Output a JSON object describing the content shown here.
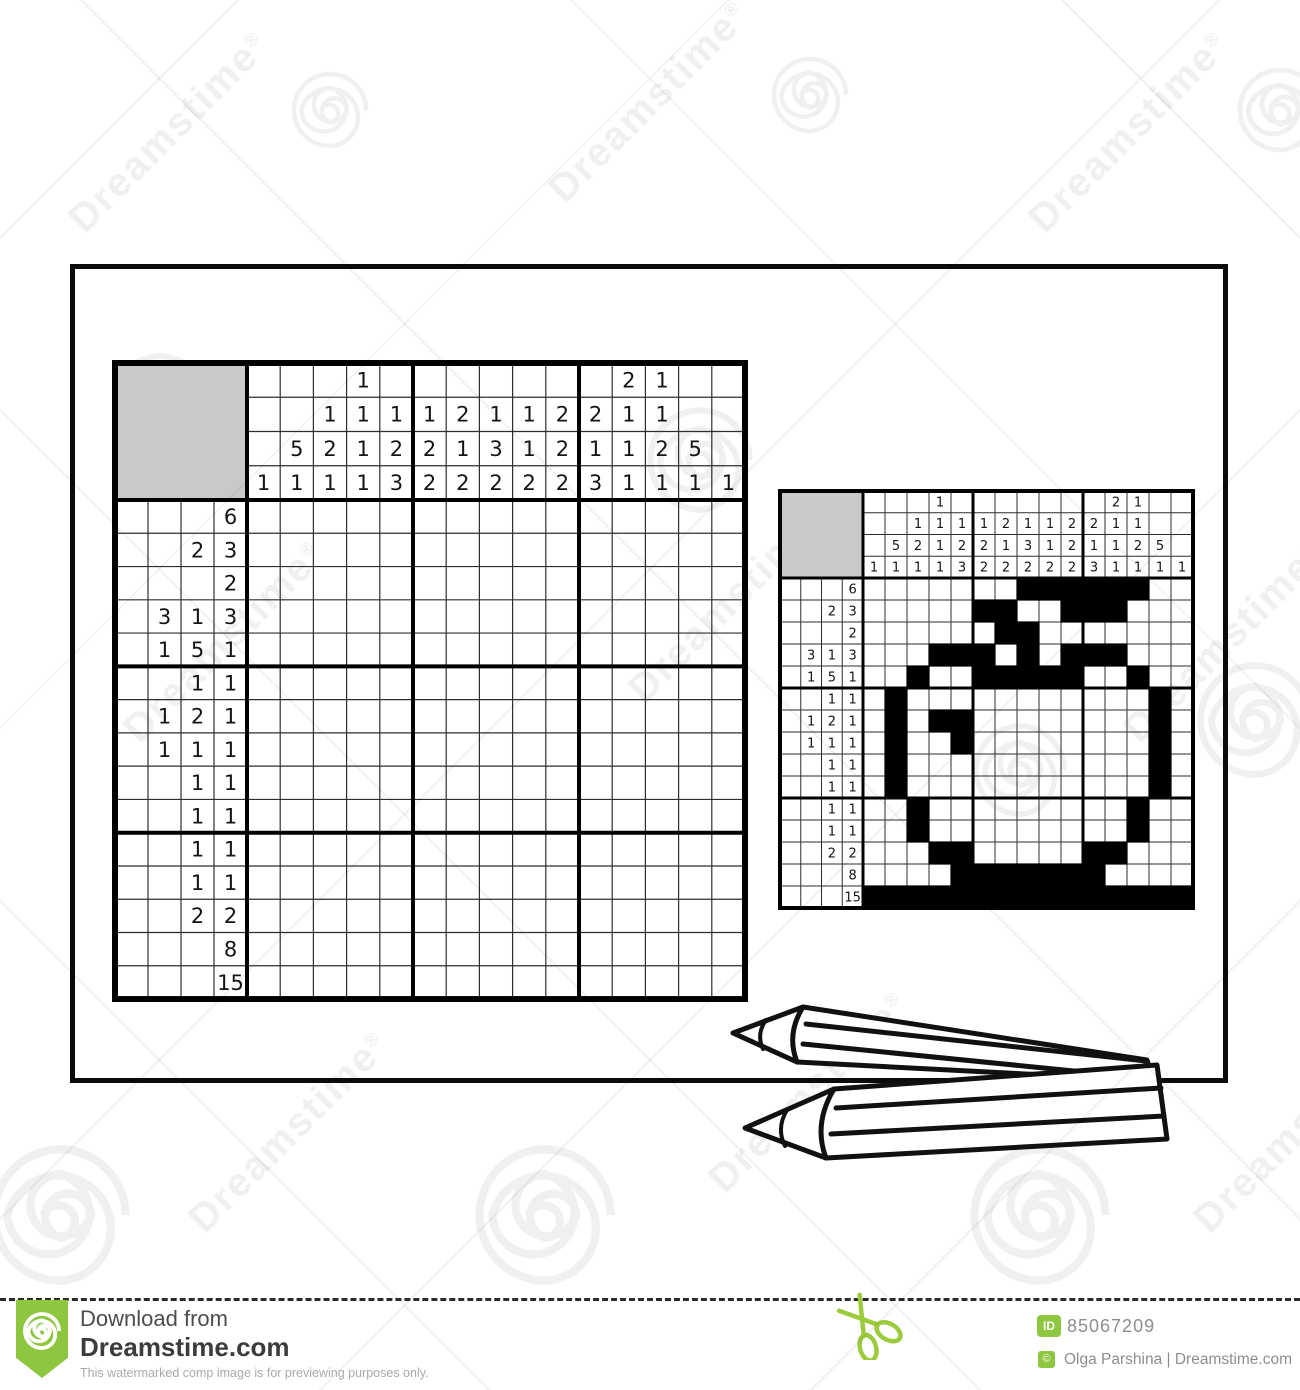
{
  "watermark": {
    "brand": "Dreamstime",
    "registered": "®"
  },
  "nonogram": {
    "size": 15,
    "clue_depth": 4,
    "row_clues": [
      [
        6
      ],
      [
        2,
        3
      ],
      [
        2
      ],
      [
        3,
        1,
        3
      ],
      [
        1,
        5,
        1
      ],
      [
        1,
        1
      ],
      [
        1,
        2,
        1
      ],
      [
        1,
        1,
        1
      ],
      [
        1,
        1
      ],
      [
        1,
        1
      ],
      [
        1,
        1
      ],
      [
        1,
        1
      ],
      [
        2,
        2
      ],
      [
        8
      ],
      [
        15
      ]
    ],
    "col_clues": [
      [
        1
      ],
      [
        5,
        1
      ],
      [
        1,
        2,
        1
      ],
      [
        1,
        1,
        1,
        1
      ],
      [
        1,
        2,
        3
      ],
      [
        1,
        2,
        2
      ],
      [
        2,
        1,
        2
      ],
      [
        1,
        3,
        2
      ],
      [
        1,
        1,
        2
      ],
      [
        2,
        2,
        2
      ],
      [
        2,
        1,
        3
      ],
      [
        2,
        1,
        1,
        1
      ],
      [
        1,
        1,
        2,
        1
      ],
      [
        5,
        1
      ],
      [
        1
      ]
    ],
    "solution": [
      "000000011111100",
      "000001100111000",
      "000000110000000",
      "000111010111000",
      "001001111100100",
      "010000000000010",
      "010110000000010",
      "010010000000010",
      "010000000000010",
      "010000000000010",
      "001000000000100",
      "001000000000100",
      "000110000011000",
      "000011111110000",
      "111111111111111"
    ]
  },
  "footer": {
    "download_label": "Download from",
    "site_name": "Dreamstime.com",
    "disclaimer": "This watermarked comp image is for previewing purposes only.",
    "id_label": "ID",
    "image_id": "85067209",
    "copyright_symbol": "©",
    "credit": "Olga Parshina | Dreamstime.com"
  },
  "colors": {
    "brand_green": "#8dc63f",
    "corner_gray": "#c9c9c9",
    "grid_black": "#000000",
    "thin_line": "#2e2e2e",
    "footer_gray": "#8e8e8e"
  }
}
